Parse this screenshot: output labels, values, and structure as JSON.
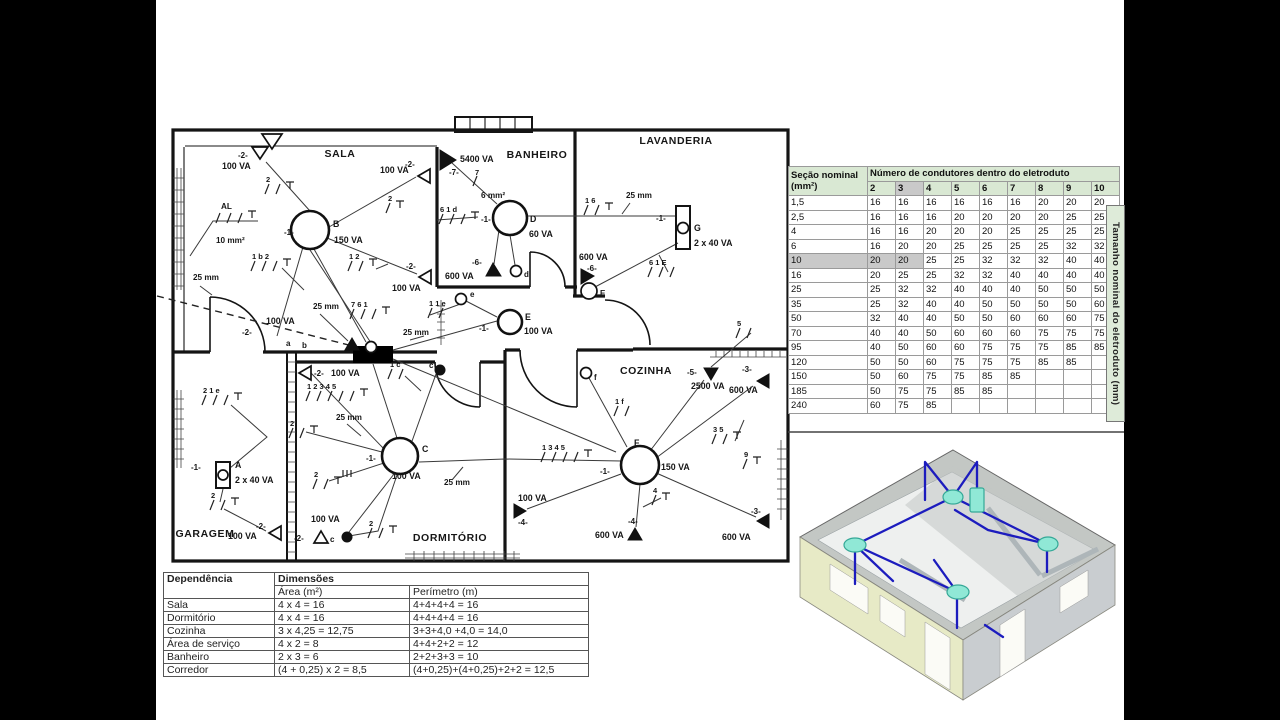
{
  "colors": {
    "table_header_green": "#d9e8d3",
    "table_shade": "#c9c9c9",
    "side_strip_green": "#deebd9",
    "house_wall_yellow": "#e7eac6",
    "house_wall_gray": "#c9cdd0",
    "house_slab_gray": "#c3c7c4",
    "conduit_blue": "#1c1cbe",
    "node_cyan": "#90e8d6"
  },
  "plan": {
    "rooms": {
      "sala": "SALA",
      "banheiro": "BANHEIRO",
      "lavanderia": "LAVANDERIA",
      "cozinha": "COZINHA",
      "dormitorio": "DORMITÓRIO",
      "garagem": "GARAGEM"
    },
    "fx": {
      "A": "A",
      "B": "B",
      "C": "C",
      "D": "D",
      "E": "E",
      "F": "F",
      "G": "G"
    },
    "sw": {
      "a": "a",
      "b": "b",
      "c": "c",
      "d": "d",
      "e": "e",
      "f": "f"
    },
    "va": {
      "va60": "60 VA",
      "va100": "100 VA",
      "va150": "150 VA",
      "va600": "600 VA",
      "va2500": "2500 VA",
      "va5400": "5400 VA",
      "va2x40": "2 x 40 VA"
    },
    "circ": {
      "c1": "-1-",
      "c2": "-2-",
      "c3": "-3-",
      "c4": "-4-",
      "c5": "-5-",
      "c6": "-6-",
      "c7": "-7-"
    },
    "cond": {
      "mm25": "25 mm",
      "mm10": "10 mm²",
      "mm6": "6 mm²",
      "al": "AL"
    },
    "ticks": {
      "t2": "2",
      "t4": "4",
      "t5": "5",
      "t7": "7",
      "t9": "9",
      "t12": "1  2",
      "t16": "1  6",
      "t35": "3  5",
      "t1c": "1 c",
      "t1f": "1 f",
      "t1b2": "1 b  2",
      "t761": "7  6  1",
      "t21e": "2  1 e",
      "t11e": "1   1 e",
      "t12345": "1 2 3 4 5",
      "t1345": "1  3  4  5",
      "t61d": "6  1 d",
      "t61E": "6  1 E"
    }
  },
  "dimension_table": {
    "col1_header": "Dependência",
    "col2_header": "Dimensões",
    "area_header": "Área (m²)",
    "perimeter_header": "Perímetro (m)",
    "rows": [
      [
        "Sala",
        "4 x 4 = 16",
        "4+4+4+4 = 16"
      ],
      [
        "Dormitório",
        "4 x 4 = 16",
        "4+4+4+4 = 16"
      ],
      [
        "Cozinha",
        "3 x 4,25 = 12,75",
        "3+3+4,0  +4,0   = 14,0"
      ],
      [
        "Área de serviço",
        "4 x 2 = 8",
        "4+4+2+2 = 12"
      ],
      [
        "Banheiro",
        "2 x 3 = 6",
        "2+2+3+3 = 10"
      ],
      [
        "Corredor",
        "(4 + 0,25) x 2 = 8,5",
        "(4+0,25)+(4+0,25)+2+2 = 12,5"
      ]
    ]
  },
  "conduit_table": {
    "title_line1": "Seção nominal",
    "title_line2": "(mm²)",
    "header": "Número de condutores dentro do eletroduto",
    "conductor_counts": [
      "2",
      "3",
      "4",
      "5",
      "6",
      "7",
      "8",
      "9",
      "10"
    ],
    "rows": [
      [
        "1,5",
        "16",
        "16",
        "16",
        "16",
        "16",
        "16",
        "20",
        "20",
        "20"
      ],
      [
        "2,5",
        "16",
        "16",
        "16",
        "20",
        "20",
        "20",
        "20",
        "25",
        "25"
      ],
      [
        "4",
        "16",
        "16",
        "20",
        "20",
        "20",
        "25",
        "25",
        "25",
        "25"
      ],
      [
        "6",
        "16",
        "20",
        "20",
        "25",
        "25",
        "25",
        "25",
        "32",
        "32"
      ],
      [
        "10",
        "20",
        "20",
        "25",
        "25",
        "32",
        "32",
        "32",
        "40",
        "40"
      ],
      [
        "16",
        "20",
        "25",
        "25",
        "32",
        "32",
        "40",
        "40",
        "40",
        "40"
      ],
      [
        "25",
        "25",
        "32",
        "32",
        "40",
        "40",
        "40",
        "50",
        "50",
        "50"
      ],
      [
        "35",
        "25",
        "32",
        "40",
        "40",
        "50",
        "50",
        "50",
        "50",
        "60"
      ],
      [
        "50",
        "32",
        "40",
        "40",
        "50",
        "50",
        "60",
        "60",
        "60",
        "75"
      ],
      [
        "70",
        "40",
        "40",
        "50",
        "60",
        "60",
        "60",
        "75",
        "75",
        "75"
      ],
      [
        "95",
        "40",
        "50",
        "60",
        "60",
        "75",
        "75",
        "75",
        "85",
        "85"
      ],
      [
        "120",
        "50",
        "50",
        "60",
        "75",
        "75",
        "75",
        "85",
        "85",
        ""
      ],
      [
        "150",
        "50",
        "60",
        "75",
        "75",
        "85",
        "85",
        "",
        "",
        ""
      ],
      [
        "185",
        "50",
        "75",
        "75",
        "85",
        "85",
        "",
        "",
        "",
        ""
      ],
      [
        "240",
        "60",
        "75",
        "85",
        "",
        "",
        "",
        "",
        "",
        ""
      ]
    ],
    "highlight": {
      "column": "3",
      "row": "10"
    },
    "side_label": "Tamanho nominal do eletroduto (mm)"
  }
}
